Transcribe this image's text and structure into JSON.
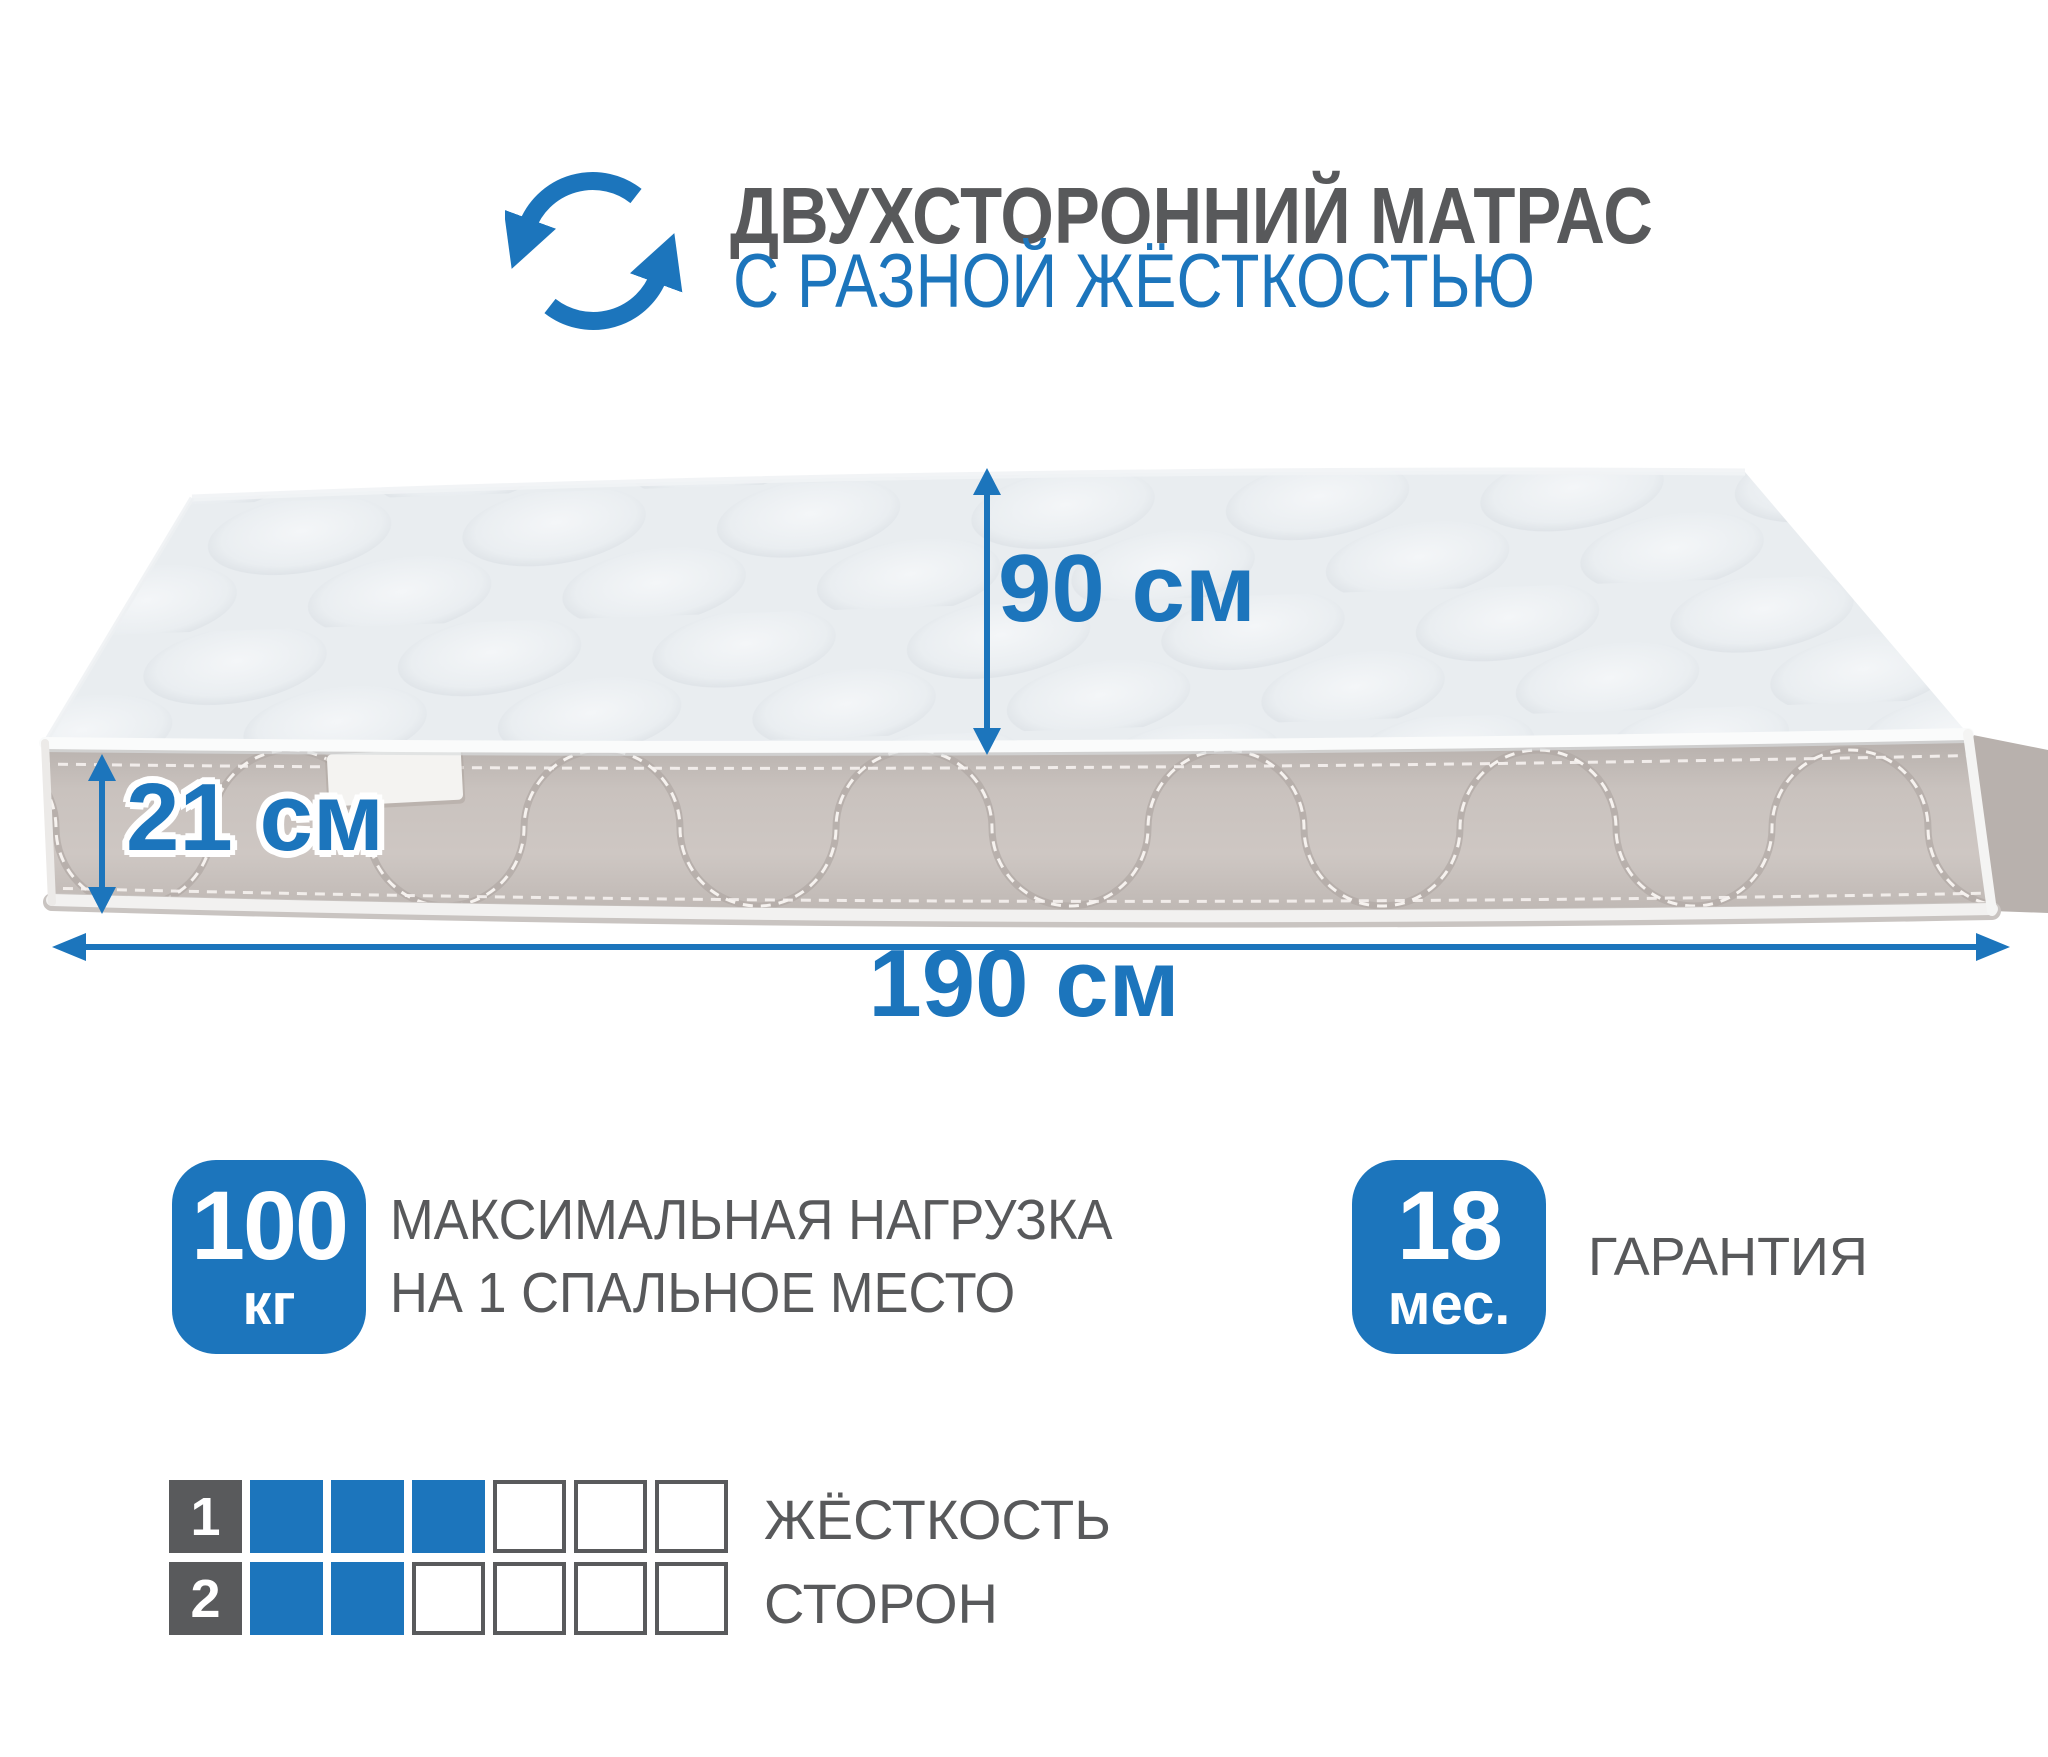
{
  "header": {
    "title": "ДВУХСТОРОННИЙ МАТРАС",
    "subtitle": "С РАЗНОЙ ЖЁСТКОСТЬЮ"
  },
  "icons": {
    "rotate_icon": "two-circular-rotate-arrows"
  },
  "dimensions": {
    "depth_label": "90 см",
    "thickness_label": "21 см",
    "length_label": "190 см"
  },
  "badges": {
    "max_load": {
      "value": "100",
      "unit": "кг",
      "caption_line1": "МАКСИМАЛЬНАЯ НАГРУЗКА",
      "caption_line2": "НА 1 СПАЛЬНОЕ МЕСТО"
    },
    "warranty": {
      "value": "18",
      "unit": "мес.",
      "caption": "ГАРАНТИЯ"
    }
  },
  "firmness": {
    "label_line1": "ЖЁСТКОСТЬ",
    "label_line2": "СТОРОН",
    "scale_max": 6,
    "rows": [
      {
        "side": "1",
        "filled": 3
      },
      {
        "side": "2",
        "filled": 2
      }
    ]
  },
  "colors": {
    "accent_blue": "#1c75bc",
    "text_gray": "#58595b",
    "mattress_top": "#e9edf0",
    "mattress_side": "#c7c0bc",
    "white": "#ffffff"
  }
}
